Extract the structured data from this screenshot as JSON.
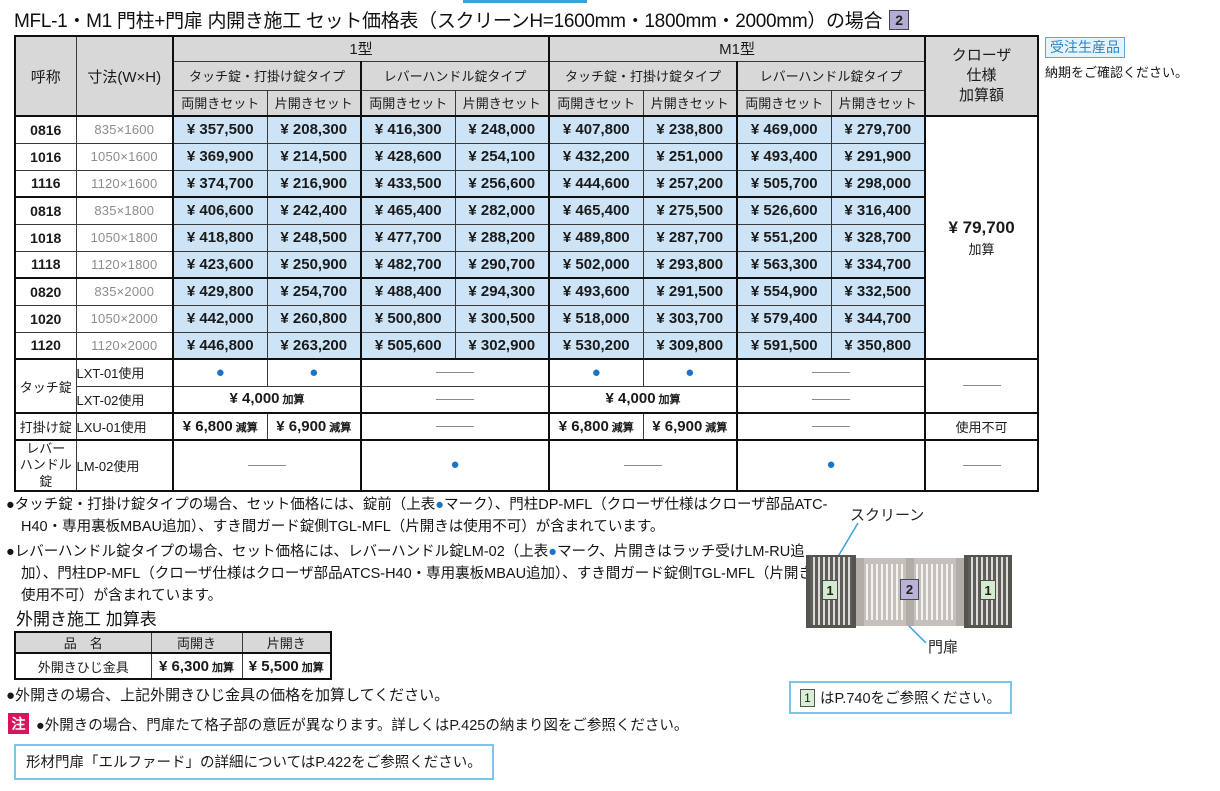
{
  "title": {
    "text": "MFL-1・M1 門柱+門扉 内開き施工 セット価格表（スクリーンH=1600mm・1800mm・2000mm）の場合",
    "badge": "2"
  },
  "production": {
    "badge": "受注生産品",
    "note": "納期をご確認ください。"
  },
  "markers": {
    "dot": "●"
  },
  "colors": {
    "price_bg": "#cde4f6",
    "header_bg": "#d8d8d8",
    "dot_blue": "#1a75c8",
    "accent_blue": "#7cc4ea",
    "caution_red": "#d6155f",
    "badge_green": "#d5ebcd",
    "badge_purple": "#b3acd6"
  },
  "price_table": {
    "col_name": "呼称",
    "col_size": "寸法(W×H)",
    "group1": "1型",
    "group2": "M1型",
    "type_touch": "タッチ錠・打掛け錠タイプ",
    "type_lever": "レバーハンドル錠タイプ",
    "set_double": "両開きセット",
    "set_single": "片開きセット",
    "col_closer": "クローザ\n仕様\n加算額",
    "closer_price": "¥ 79,700",
    "closer_suffix": "加算",
    "rows": [
      {
        "name": "0816",
        "size": "835×1600",
        "prices": [
          "¥ 357,500",
          "¥ 208,300",
          "¥ 416,300",
          "¥ 248,000",
          "¥ 407,800",
          "¥ 238,800",
          "¥ 469,000",
          "¥ 279,700"
        ]
      },
      {
        "name": "1016",
        "size": "1050×1600",
        "prices": [
          "¥ 369,900",
          "¥ 214,500",
          "¥ 428,600",
          "¥ 254,100",
          "¥ 432,200",
          "¥ 251,000",
          "¥ 493,400",
          "¥ 291,900"
        ]
      },
      {
        "name": "1116",
        "size": "1120×1600",
        "prices": [
          "¥ 374,700",
          "¥ 216,900",
          "¥ 433,500",
          "¥ 256,600",
          "¥ 444,600",
          "¥ 257,200",
          "¥ 505,700",
          "¥ 298,000"
        ]
      },
      {
        "name": "0818",
        "size": "835×1800",
        "prices": [
          "¥ 406,600",
          "¥ 242,400",
          "¥ 465,400",
          "¥ 282,000",
          "¥ 465,400",
          "¥ 275,500",
          "¥ 526,600",
          "¥ 316,400"
        ]
      },
      {
        "name": "1018",
        "size": "1050×1800",
        "prices": [
          "¥ 418,800",
          "¥ 248,500",
          "¥ 477,700",
          "¥ 288,200",
          "¥ 489,800",
          "¥ 287,700",
          "¥ 551,200",
          "¥ 328,700"
        ]
      },
      {
        "name": "1118",
        "size": "1120×1800",
        "prices": [
          "¥ 423,600",
          "¥ 250,900",
          "¥ 482,700",
          "¥ 290,700",
          "¥ 502,000",
          "¥ 293,800",
          "¥ 563,300",
          "¥ 334,700"
        ]
      },
      {
        "name": "0820",
        "size": "835×2000",
        "prices": [
          "¥ 429,800",
          "¥ 254,700",
          "¥ 488,400",
          "¥ 294,300",
          "¥ 493,600",
          "¥ 291,500",
          "¥ 554,900",
          "¥ 332,500"
        ]
      },
      {
        "name": "1020",
        "size": "1050×2000",
        "prices": [
          "¥ 442,000",
          "¥ 260,800",
          "¥ 500,800",
          "¥ 300,500",
          "¥ 518,000",
          "¥ 303,700",
          "¥ 579,400",
          "¥ 344,700"
        ]
      },
      {
        "name": "1120",
        "size": "1120×2000",
        "prices": [
          "¥ 446,800",
          "¥ 263,200",
          "¥ 505,600",
          "¥ 302,900",
          "¥ 530,200",
          "¥ 309,800",
          "¥ 591,500",
          "¥ 350,800"
        ]
      }
    ]
  },
  "lock_table": {
    "touch": {
      "category": "タッチ錠",
      "rows": [
        {
          "label": "LXT-01使用"
        },
        {
          "label": "LXT-02使用",
          "price": "¥ 4,000",
          "price_suffix": "加算"
        }
      ]
    },
    "latch": {
      "category": "打掛け錠",
      "label": "LXU-01使用",
      "double_price": "¥ 6,800",
      "double_suffix": "減算",
      "single_price": "¥ 6,900",
      "single_suffix": "減算",
      "closer_note": "使用不可"
    },
    "lever": {
      "category": "レバー\nハンドル錠",
      "label": "LM-02使用"
    }
  },
  "notes": [
    {
      "bullet": "●",
      "pre": "タッチ錠・打掛け錠タイプの場合、セット価格には、錠前（上表",
      "mark": "●",
      "post": "マーク）、門柱DP-MFL（クローザ仕様はクローザ部品ATC-H40・専用裏板MBAU追加）、すき間ガード錠側TGL-MFL（片開きは使用不可）が含まれています。"
    },
    {
      "bullet": "●",
      "pre": "レバーハンドル錠タイプの場合、セット価格には、レバーハンドル錠LM-02（上表",
      "mark": "●",
      "post": "マーク、片開きはラッチ受けLM-RU追加）、門柱DP-MFL（クローザ仕様はクローザ部品ATCS-H40・専用裏板MBAU追加）、すき間ガード錠側TGL-MFL（片開きは使用不可）が含まれています。"
    }
  ],
  "outward": {
    "title": "外開き施工 加算表",
    "col_product": "品　名",
    "col_double": "両開き",
    "col_single": "片開き",
    "product": "外開きひじ金具",
    "double_price": "¥ 6,300",
    "double_suffix": "加算",
    "single_price": "¥ 5,500",
    "single_suffix": "加算",
    "note_bullet": "●",
    "note": "外開きの場合、上記外開きひじ金具の価格を加算してください。"
  },
  "caution": {
    "badge": "注",
    "bullet": "●",
    "text": "外開きの場合、門扉たて格子部の意匠が異なります。詳しくはP.425の納まり図をご参照ください。"
  },
  "info_box": {
    "text": "形材門扉「エルファード」の詳細についてはP.422をご参照ください。"
  },
  "diagram": {
    "label_screen": "スクリーン",
    "label_gate": "門扉",
    "badge_screen": "1",
    "badge_gate": "2"
  },
  "ref_box": {
    "badge": "1",
    "text": "はP.740をご参照ください。"
  }
}
